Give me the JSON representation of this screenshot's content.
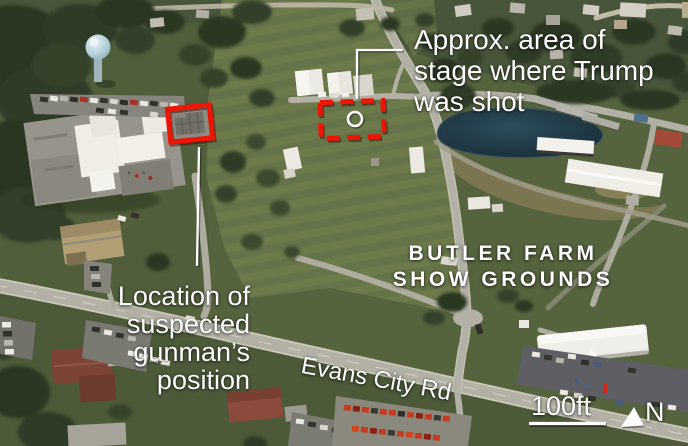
{
  "annotations": {
    "stage_label": "Approx. area of\nstage where Trump\nwas shot",
    "gunman_label": "Location of\nsuspected\ngunman’s\nposition"
  },
  "map_labels": {
    "venue_name": "BUTLER FARM\nSHOW GROUNDS",
    "road_name": "Evans City Rd"
  },
  "scale_bar": {
    "label": "100ft"
  },
  "compass": {
    "label": "N"
  },
  "colors": {
    "annotation_red": "#ee1505",
    "label_white": "#ffffff",
    "pond_blue": "#203b4a",
    "grass_green": "#55633e",
    "road_gray": "#b3b1a5"
  }
}
